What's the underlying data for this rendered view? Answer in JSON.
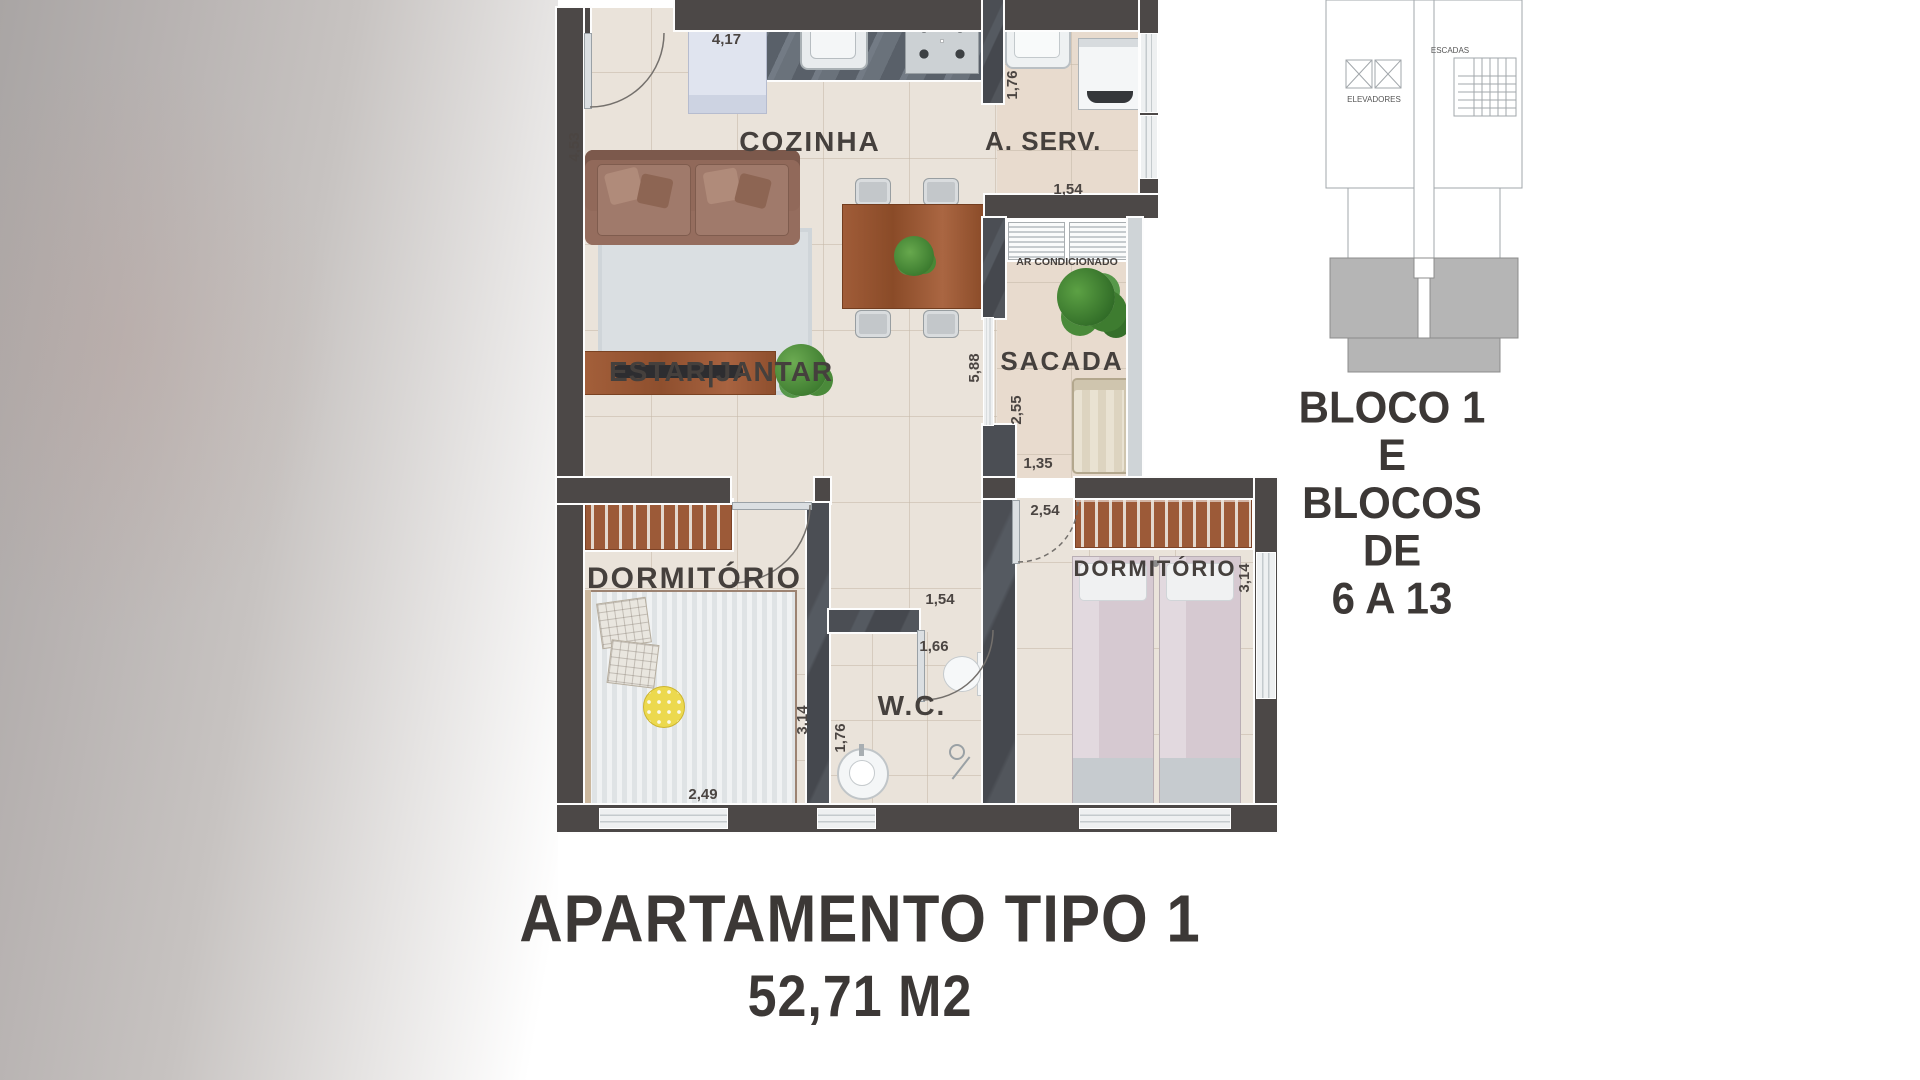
{
  "title": {
    "line1": "APARTAMENTO TIPO 1",
    "line2": "52,71 M2"
  },
  "key_plan": {
    "elevators_label": "ELEVADORES",
    "stairs_label": "ESCADAS",
    "caption": [
      "BLOCO 1",
      "E",
      "BLOCOS",
      "DE",
      "6 A 13"
    ]
  },
  "floor_plan": {
    "room_labels": {
      "kitchen": "COZINHA",
      "service_area": "A. SERV.",
      "living_dining": "ESTAR|JANTAR",
      "balcony": "SACADA",
      "air_conditioner": "AR CONDICIONADO",
      "bedroom_left": "DORMITÓRIO",
      "bedroom_right": "DORMITÓRIO",
      "bathroom": "W.C."
    },
    "dimensions": {
      "kitchen_width": "4,17",
      "kitchen_left_height": "4,53",
      "service_height": "1,76",
      "service_bottom": "1,54",
      "living_height": "5,88",
      "balcony_height": "2,55",
      "balcony_bottom": "1,35",
      "bedroom_right_top": "2,54",
      "bedroom_right_side": "3,14",
      "hall_width": "1,54",
      "wc_width": "1,66",
      "wc_height": "1,76",
      "bedroom_left_side": "3,14",
      "bedroom_left_bottom": "2,49"
    }
  },
  "colors": {
    "wall": "#4c4847",
    "floor": "#eae3da",
    "floor_warm": "#e8dbce",
    "wood": "#9c5a38",
    "plant": "#4e8f3c",
    "unit_highlight": "#b5b5b5",
    "text": "#3f3b39"
  }
}
